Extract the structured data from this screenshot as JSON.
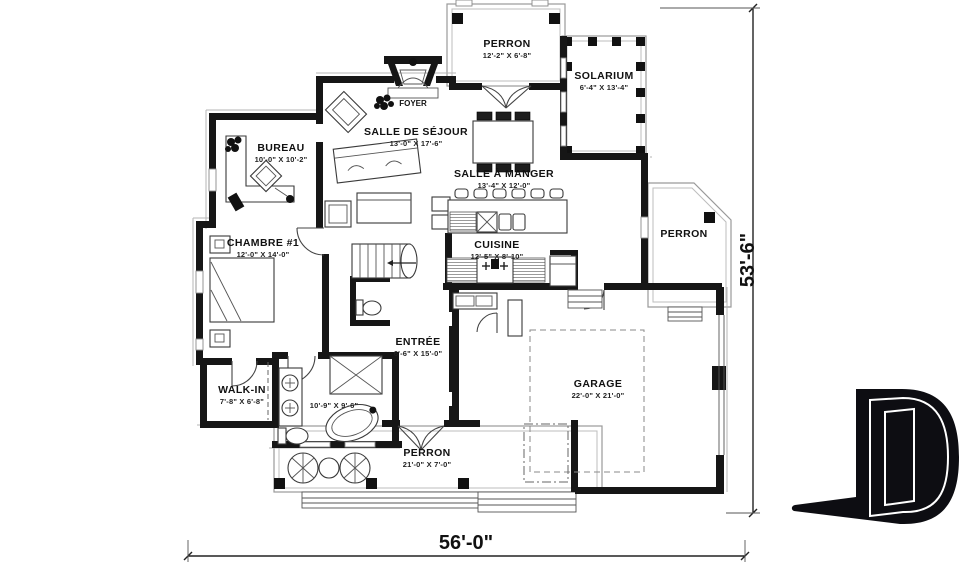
{
  "rooms": {
    "perron_top": {
      "name": "PERRON",
      "dims": "12'-2\" X 6'-8\""
    },
    "solarium": {
      "name": "SOLARIUM",
      "dims": "6'-4\" X 13'-4\""
    },
    "foyer": {
      "name": "FOYER"
    },
    "salle_de_sejour": {
      "name": "SALLE DE SÉJOUR",
      "dims": "13'-0\" X 17'-6\""
    },
    "salle_a_manger": {
      "name": "SALLE À MANGER",
      "dims": "13'-4\" X 12'-0\""
    },
    "bureau": {
      "name": "BUREAU",
      "dims": "10'-0\" X 10'-2\""
    },
    "chambre_1": {
      "name": "CHAMBRE #1",
      "dims": "12'-0\" X 14'-0\""
    },
    "cuisine": {
      "name": "CUISINE",
      "dims": "12'-5\" X 8'-10\""
    },
    "entree": {
      "name": "ENTRÉE",
      "dims": "6'-6\" X 15'-0\""
    },
    "walk_in": {
      "name": "WALK-IN",
      "dims": "7'-8\" X 6'-8\""
    },
    "salle_de_bain": {
      "dims": "10'-9\" X 9'-6\""
    },
    "garage": {
      "name": "GARAGE",
      "dims": "22'-0\" X 21'-0\""
    },
    "perron_right": {
      "name": "PERRON"
    },
    "perron_bottom": {
      "name": "PERRON",
      "dims": "21'-0\" X 7'-0\""
    }
  },
  "dimensions": {
    "overall_width": "56'-0\"",
    "overall_height": "53'-6\""
  },
  "logo": {
    "letter": "D"
  }
}
